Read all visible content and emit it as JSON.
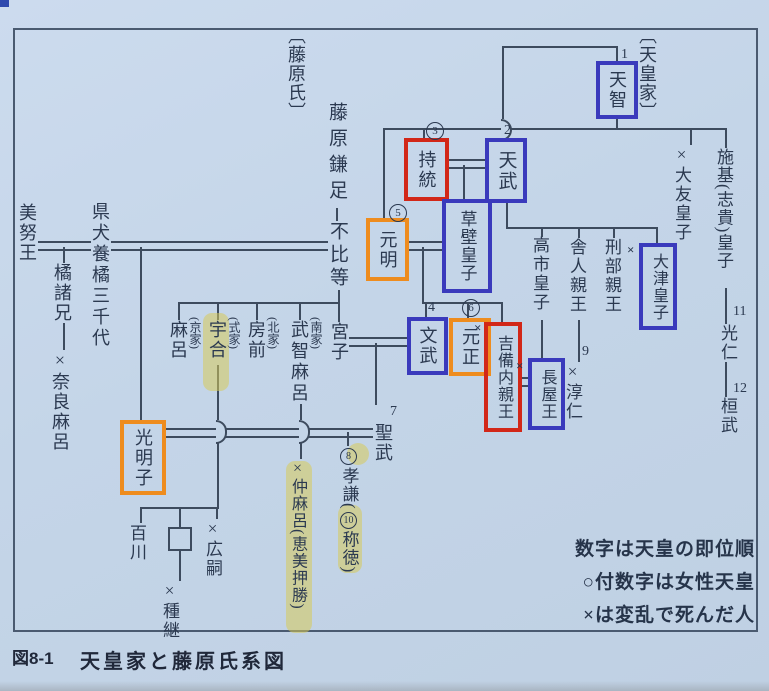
{
  "colors": {
    "page_bg": "#c4d5e8",
    "line": "#3d4b5e",
    "text": "#2b3950",
    "box_blue": "#3a3abc",
    "box_red": "#d22718",
    "box_orange": "#ee8c1e",
    "highlight": "#d7cb5a"
  },
  "labels": {
    "fujiwara_clan": "〔藤原氏〕",
    "imperial_house": "〔天皇家〕"
  },
  "legend": {
    "line1": "数字は天皇の即位順",
    "line2": "○付数字は女性天皇",
    "line3": "×は変乱で死んだ人"
  },
  "caption": {
    "figure_no": "図8-1",
    "title": "天皇家と藤原氏系図"
  },
  "people": {
    "tenji": {
      "name": "天智",
      "num": "1"
    },
    "tenmu": {
      "name": "天武",
      "num": "2"
    },
    "jito": {
      "name": "持統",
      "num": "3"
    },
    "kusakabe": {
      "name": "草壁皇子"
    },
    "genmei": {
      "name": "元明",
      "num": "5"
    },
    "gensho": {
      "name": "元正",
      "num": "6"
    },
    "monmu": {
      "name": "文武",
      "num": "4"
    },
    "shomu": {
      "name": "聖武",
      "num": "7"
    },
    "koken": {
      "num": "8",
      "name": "孝謙",
      "paren_open": "(",
      "num2": "10",
      "alt_name": "称徳",
      "paren_close": ")"
    },
    "junnin": {
      "name": "×淳仁",
      "num": "9"
    },
    "konin": {
      "name": "光仁",
      "num": "11"
    },
    "kanmu": {
      "name": "桓武",
      "num": "12"
    },
    "otomo": {
      "name": "×大友皇子"
    },
    "shiki": {
      "name": "施基(志貴)皇子"
    },
    "otsu": {
      "name": "大津皇子",
      "cross": "×"
    },
    "takechi": {
      "name": "高市皇子"
    },
    "toneri": {
      "name": "舎人親王"
    },
    "osakabe": {
      "name": "刑部親王"
    },
    "nagaya": {
      "name": "長屋王",
      "cross": "×"
    },
    "kibi": {
      "name": "吉備内親王",
      "cross": "×"
    },
    "kamatari": {
      "name": "藤原鎌足"
    },
    "fuhito": {
      "name": "不比等"
    },
    "minoo": {
      "name": "美努王"
    },
    "michiyo": {
      "name": "県犬養橘三千代"
    },
    "moroe": {
      "name": "橘諸兄"
    },
    "naramaro": {
      "name": "×奈良麻呂"
    },
    "maro": {
      "name": "麻呂",
      "house": "(京家)"
    },
    "umakai": {
      "name": "宇合",
      "house": "(式家)"
    },
    "fusasaki": {
      "name": "房前",
      "house": "(北家)"
    },
    "muchimaro": {
      "name": "武智麻呂",
      "house": "(南家)"
    },
    "miyako": {
      "name": "宮子"
    },
    "komyoshi": {
      "name": "光明子"
    },
    "nakamaro": {
      "name": "×仲麻呂(恵美押勝)"
    },
    "momokawa": {
      "name": "百川"
    },
    "hirotsugu": {
      "name": "×広嗣"
    },
    "tanetsugu": {
      "name": "×種継"
    }
  }
}
